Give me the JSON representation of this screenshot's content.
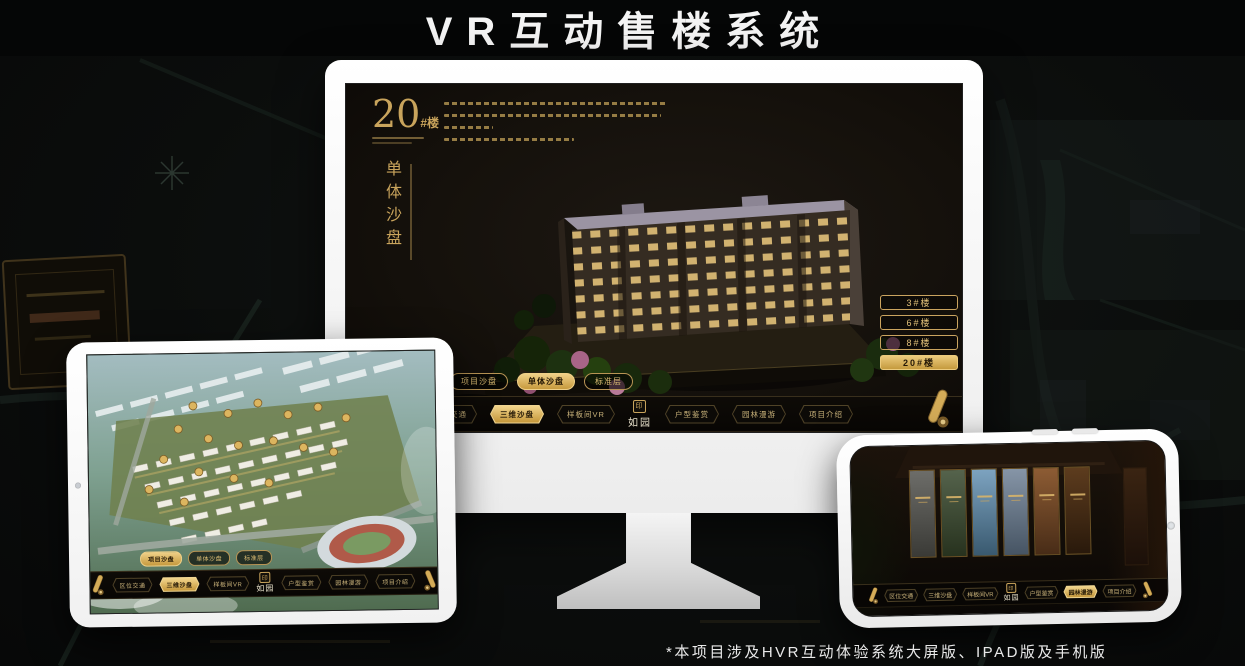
{
  "page": {
    "title": "VR互动售楼系统",
    "footnote": "*本项目涉及HVR互动体验系统大屏版、IPAD版及手机版"
  },
  "colors": {
    "gold": "#C9A45C",
    "gold_bright": "#E9C877",
    "active_button_bg": "#D4A946",
    "screen_bg": "#16120D",
    "page_bg": "#0B0D0C",
    "title_color": "#F4F4F4"
  },
  "monitor": {
    "heading": {
      "number": "20",
      "suffix": "#楼",
      "subtitle": "单体沙盘"
    },
    "floor_buttons": [
      {
        "label": "3#楼"
      },
      {
        "label": "6#楼"
      },
      {
        "label": "8#楼"
      },
      {
        "label": "20#楼"
      }
    ],
    "active_floor": "20#楼",
    "sub_tabs": [
      {
        "label": "项目沙盘"
      },
      {
        "label": "单体沙盘"
      },
      {
        "label": "标准层"
      }
    ],
    "active_sub_tab": "单体沙盘",
    "nav": {
      "logo": "如园",
      "items": [
        {
          "label": "区位交通"
        },
        {
          "label": "三维沙盘"
        },
        {
          "label": "样板间VR"
        },
        {
          "label": "户型鉴赏"
        },
        {
          "label": "园林漫游"
        },
        {
          "label": "项目介绍"
        }
      ],
      "active_item": "三维沙盘"
    }
  },
  "tablet": {
    "sub_tabs": [
      {
        "label": "项目沙盘"
      },
      {
        "label": "单体沙盘"
      },
      {
        "label": "标准层"
      }
    ],
    "active_sub_tab": "项目沙盘",
    "nav": {
      "logo": "如园",
      "items": [
        {
          "label": "区位交通"
        },
        {
          "label": "三维沙盘"
        },
        {
          "label": "样板间VR"
        },
        {
          "label": "户型鉴赏"
        },
        {
          "label": "园林漫游"
        },
        {
          "label": "项目介绍"
        }
      ],
      "active_item": "三维沙盘"
    }
  },
  "phone": {
    "nav": {
      "logo": "如园",
      "items": [
        {
          "label": "区位交通"
        },
        {
          "label": "三维沙盘"
        },
        {
          "label": "样板间VR"
        },
        {
          "label": "户型鉴赏"
        },
        {
          "label": "园林漫游"
        },
        {
          "label": "项目介绍"
        }
      ],
      "active_item": "园林漫游"
    }
  }
}
